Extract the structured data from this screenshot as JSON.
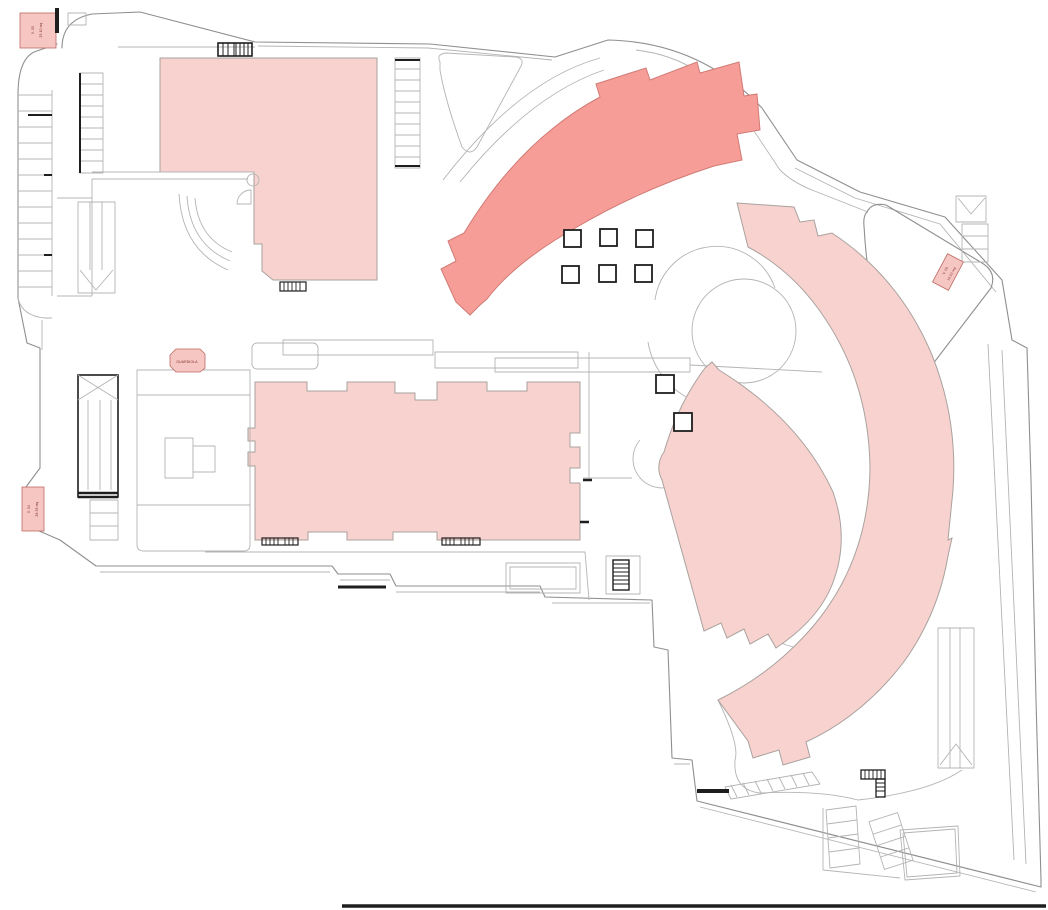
{
  "plan": {
    "colors": {
      "building_light": "#f8d2ce",
      "building_dark": "#f79d98",
      "building_light_stroke": "#a9a29f",
      "building_dark_stroke": "#d07b75",
      "line_gray": "#8f8f8f",
      "line_light": "#b4b4b4",
      "line_dark": "#1e1e1e",
      "note_fill": "#f5c6c2",
      "note_stroke": "#bc6a64",
      "note_text": "#7c2a25"
    },
    "annotations": {
      "note_nw": {
        "line1": "V. 05",
        "line2": "25.10 mq"
      },
      "note_w": {
        "line1": "V. 04",
        "line2": "28.35 mq"
      },
      "note_e": {
        "line1": "V. 06",
        "line2": "15.20 mq"
      },
      "kiosk": {
        "label": "GUARDIOLA"
      }
    },
    "symbols": {
      "square_grid": {
        "rows": 2,
        "cols": 3,
        "count": 6
      },
      "single_squares": 2
    }
  }
}
